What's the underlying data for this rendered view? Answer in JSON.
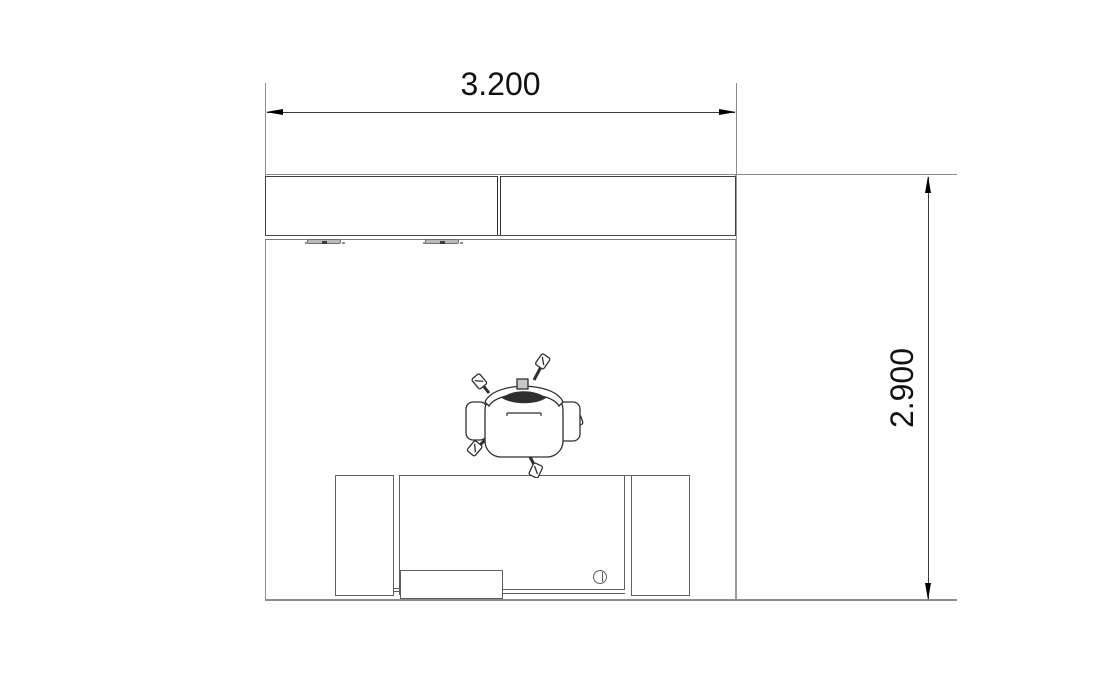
{
  "page": {
    "background": "#ffffff",
    "width_px": 1108,
    "height_px": 690
  },
  "dimensions": {
    "horizontal": {
      "label": "3.200"
    },
    "vertical": {
      "label": "2.900"
    }
  },
  "colors": {
    "wall_line": "#8c8c8c",
    "cabinet_line": "#3d3d3d",
    "desk_line": "#5f5f5f",
    "chair_line": "#2f2f2f",
    "dimension_line": "#3a3a3a",
    "arrow": "#000000",
    "text": "#111111"
  },
  "plan": {
    "type": "room-floor-plan",
    "room": {
      "width_label": "3.200",
      "depth_label": "2.900"
    },
    "furniture": [
      {
        "name": "wall-cabinet",
        "sections": 2,
        "handles": 2
      },
      {
        "name": "desk",
        "pedestals": 2,
        "keyboard_tray": true,
        "cable_grommet": true
      },
      {
        "name": "office-chair",
        "casters": 5,
        "armrests": 2
      }
    ]
  }
}
